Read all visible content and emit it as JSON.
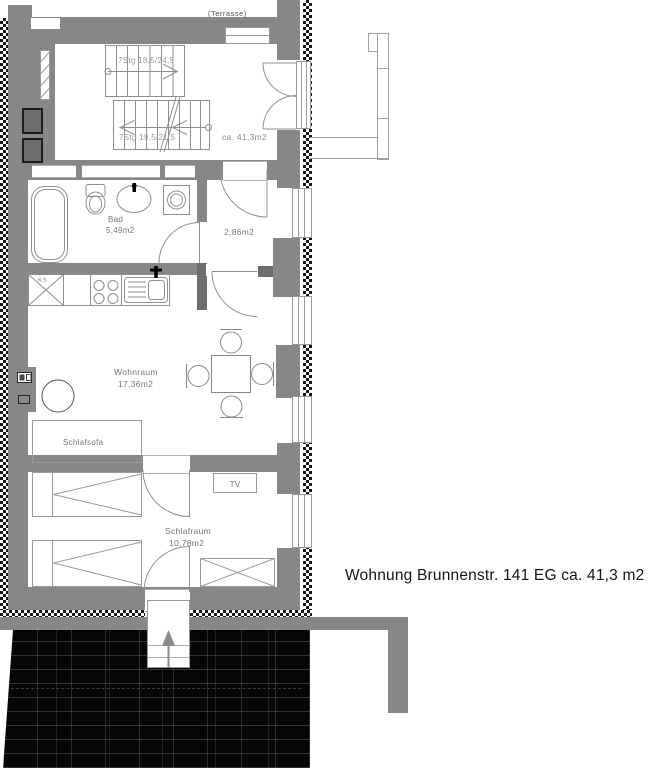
{
  "annotation": "Wohnung Brunnenstr. 141 EG ca. 41,3 m2",
  "colors": {
    "wall": "#878787",
    "wall_dark": "#6e6e6e",
    "terrace": "#060606",
    "label": "#767676"
  },
  "stairs": {
    "upper_label": "7Stg 18,5/24,5",
    "lower_label": "7Stg 19,5/21,5"
  },
  "rooms": {
    "entry_area": "ca. 41,3m2",
    "bad_name": "Bad",
    "bad_area": "5,49m2",
    "hall_area": "2,86m2",
    "wohnraum_name": "Wohnraum",
    "wohnraum_area": "17,36m2",
    "schlafraum_name": "Schlafraum",
    "schlafraum_area": "10,78m2",
    "terrasse": "(Terrasse)"
  },
  "furniture": {
    "schlafsofa": "Schlafsofa",
    "tv": "TV",
    "fridge": "KS"
  }
}
